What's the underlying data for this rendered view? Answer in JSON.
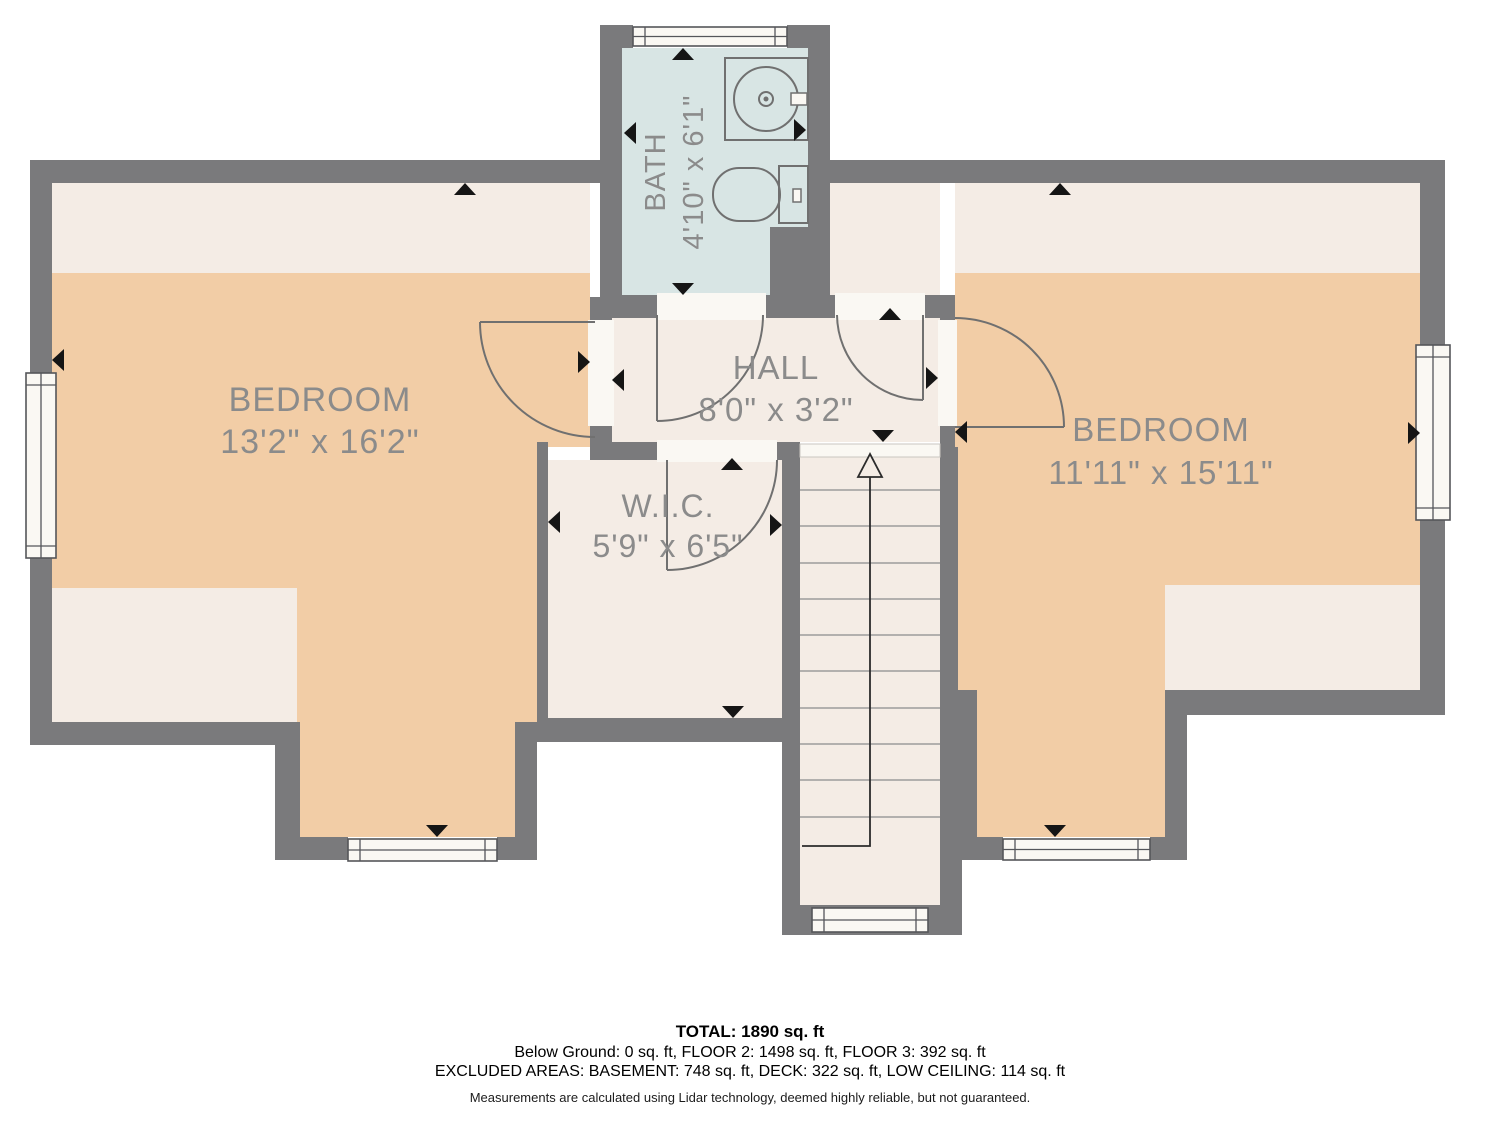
{
  "rooms": {
    "bath": {
      "label": "BATH",
      "dims": "4'10\" x 6'1\""
    },
    "bedroom_left": {
      "label": "BEDROOM",
      "dims": "13'2\" x 16'2\""
    },
    "hall": {
      "label": "HALL",
      "dims": "8'0\" x 3'2\""
    },
    "wic": {
      "label": "W.I.C.",
      "dims": "5'9\" x 6'5\""
    },
    "bedroom_right": {
      "label": "BEDROOM",
      "dims": "11'11\" x 15'11\""
    }
  },
  "title_block": {
    "total": "TOTAL: 1890 sq. ft",
    "floors_line": "Below Ground: 0 sq. ft, FLOOR 2: 1498 sq. ft, FLOOR 3: 392 sq. ft",
    "excluded_line": "EXCLUDED AREAS: BASEMENT: 748 sq. ft, DECK: 322 sq. ft, LOW CEILING: 114 sq. ft",
    "disclaimer": "Measurements are calculated using Lidar technology, deemed highly reliable, but not guaranteed."
  },
  "icons": {
    "sink": "sink-icon",
    "toilet": "toilet-icon",
    "stairs": "stairs-up-arrow",
    "door": "door-swing-arc",
    "window": "window-symbol",
    "wall_marker": "wall-marker-triangle"
  },
  "colors": {
    "wall": "#7a7a7c",
    "room_tan": "#f2cda6",
    "room_cream": "#f4ece5",
    "bath_blue": "#d8e5e4",
    "label_text": "#8b8b8b",
    "summary_text": "#000000"
  }
}
